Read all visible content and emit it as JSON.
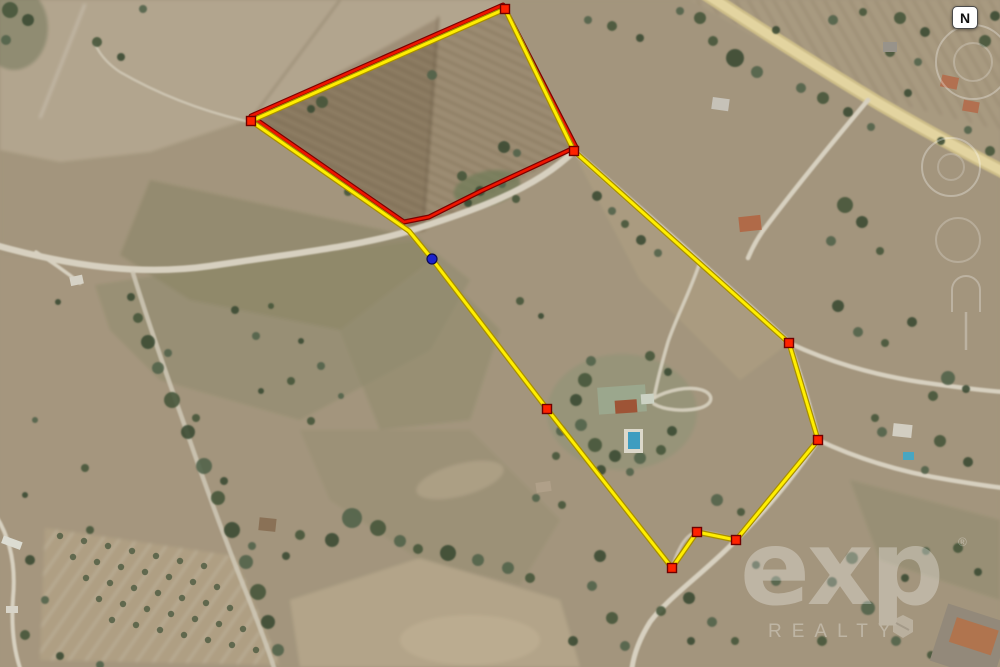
{
  "compass": {
    "label": "N"
  },
  "watermark": {
    "brand": "exp",
    "registered": "®",
    "subtitle": "REALTY"
  },
  "overlay": {
    "colors": {
      "boundary_yellow": "#ffee00",
      "boundary_yellow_edge": "#a88f00",
      "boundary_red": "#ee1500",
      "boundary_red_edge": "#7d0000",
      "vertex_marker": "#ff2200",
      "vertex_marker_edge": "#6e0000",
      "point_marker_blue": "#1c23cc",
      "point_marker_blue_edge": "#0a0a50"
    },
    "yellow_boundary_points": [
      [
        505,
        9
      ],
      [
        574,
        151
      ],
      [
        789,
        343
      ],
      [
        818,
        440
      ],
      [
        736,
        540
      ],
      [
        697,
        532
      ],
      [
        672,
        568
      ],
      [
        547,
        409
      ],
      [
        432,
        259
      ],
      [
        409,
        231
      ],
      [
        251,
        121
      ]
    ],
    "red_boundary_points": [
      [
        251,
        116
      ],
      [
        503,
        5
      ],
      [
        576,
        147
      ],
      [
        481,
        191
      ],
      [
        429,
        217
      ],
      [
        404,
        222
      ]
    ],
    "vertex_markers": [
      [
        505,
        9
      ],
      [
        251,
        121
      ],
      [
        574,
        151
      ],
      [
        789,
        343
      ],
      [
        818,
        440
      ],
      [
        736,
        540
      ],
      [
        697,
        532
      ],
      [
        672,
        568
      ],
      [
        547,
        409
      ]
    ],
    "blue_point": [
      432,
      259
    ]
  }
}
